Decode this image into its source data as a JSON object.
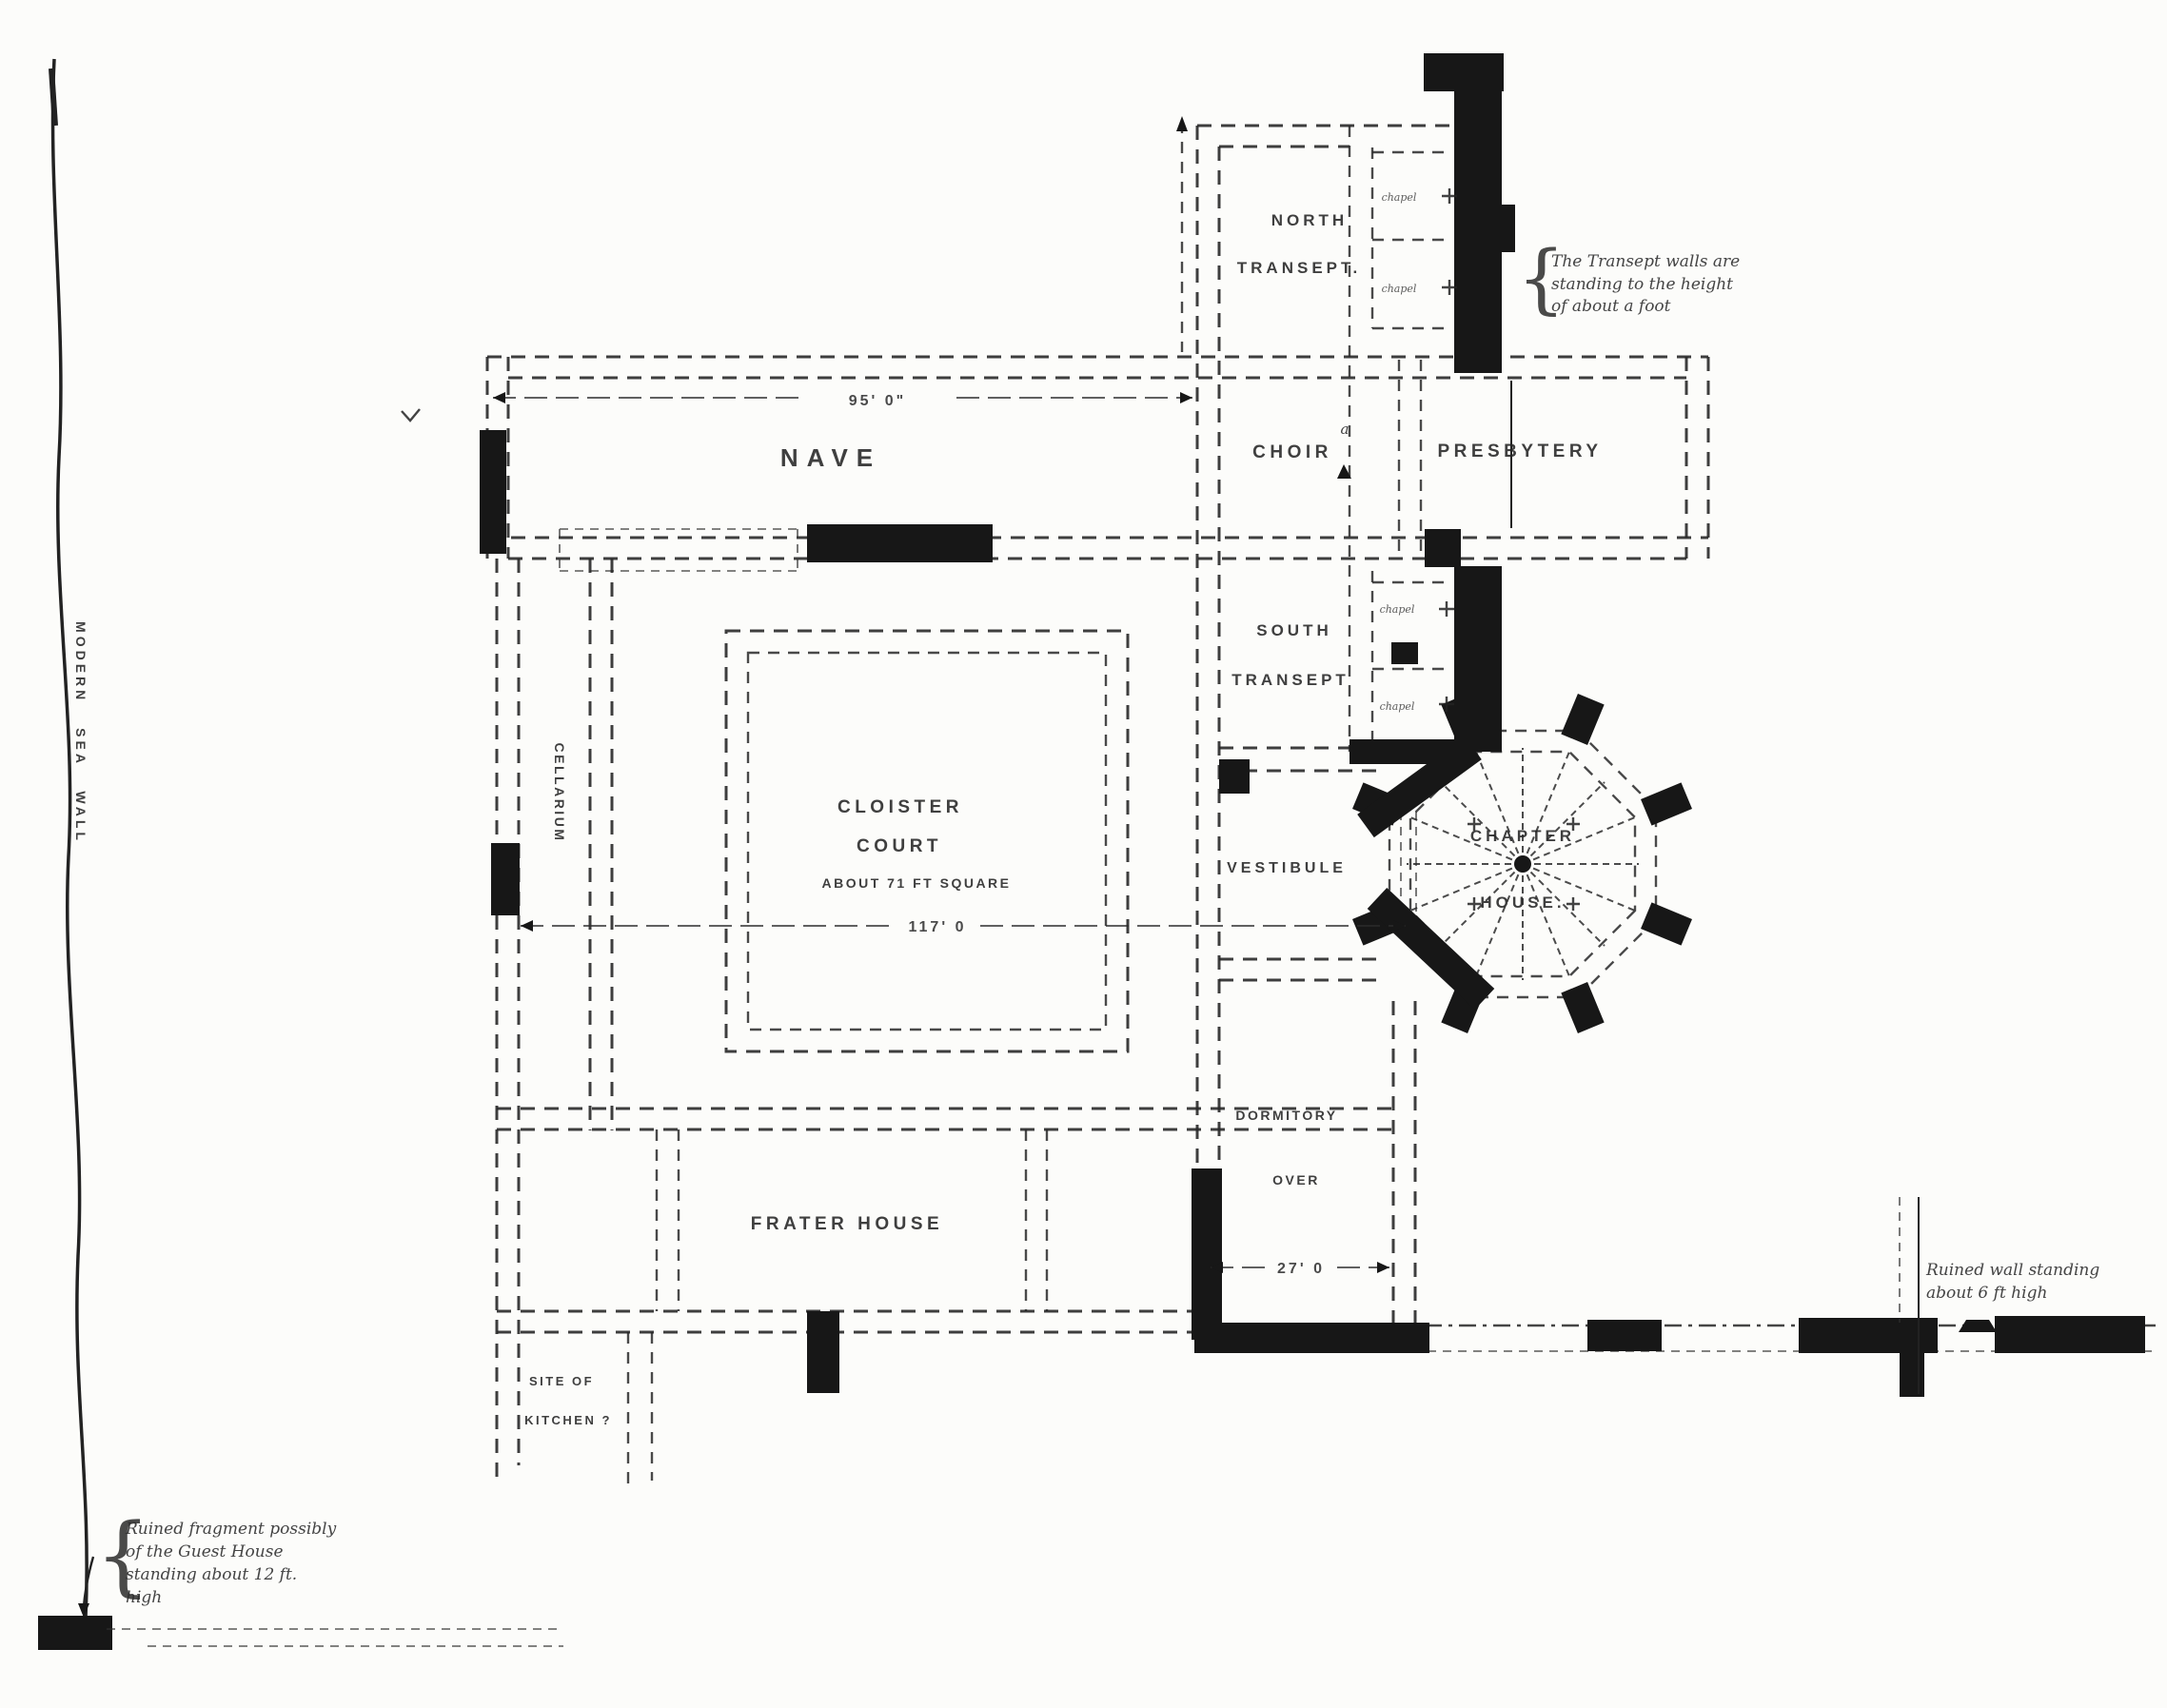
{
  "colors": {
    "ink": "#262626",
    "paper": "#fcfcfa",
    "fragment_fill": "#171717"
  },
  "church": {
    "nave": "NAVE",
    "nave_dim": "95' 0\"",
    "choir": "CHOIR",
    "presbytery": "PRESBYTERY",
    "north_transept_line1": "NORTH",
    "north_transept_line2": "TRANSEPT.",
    "south_transept_line1": "SOUTH",
    "south_transept_line2": "TRANSEPT",
    "chapel_label": "chapel",
    "altar_mark": "a"
  },
  "cloister": {
    "court_line1": "CLOISTER",
    "court_line2": "COURT",
    "court_note": "ABOUT 71 FT SQUARE",
    "court_dim": "117' 0",
    "cellarium": "CELLARIUM",
    "vestibule": "VESTIBULE",
    "chapter_line1": "CHAPTER",
    "chapter_line2": "HOUSE.",
    "dormitory_line1": "DORMITORY",
    "dormitory_line2": "OVER",
    "dormitory_dim": "27' 0",
    "frater": "FRATER HOUSE",
    "kitchen_line1": "SITE OF",
    "kitchen_line2": "KITCHEN ?"
  },
  "annotations": {
    "sea_wall": "MODERN SEA WALL",
    "brace": "{",
    "transept_note": [
      "The Transept walls are",
      "standing to the height",
      "of about a foot"
    ],
    "guest_note": [
      "Ruined fragment possibly",
      "of the Guest House",
      "standing about 12 ft.",
      "high"
    ],
    "wall_note": [
      "Ruined wall standing",
      "about 6 ft high"
    ]
  }
}
